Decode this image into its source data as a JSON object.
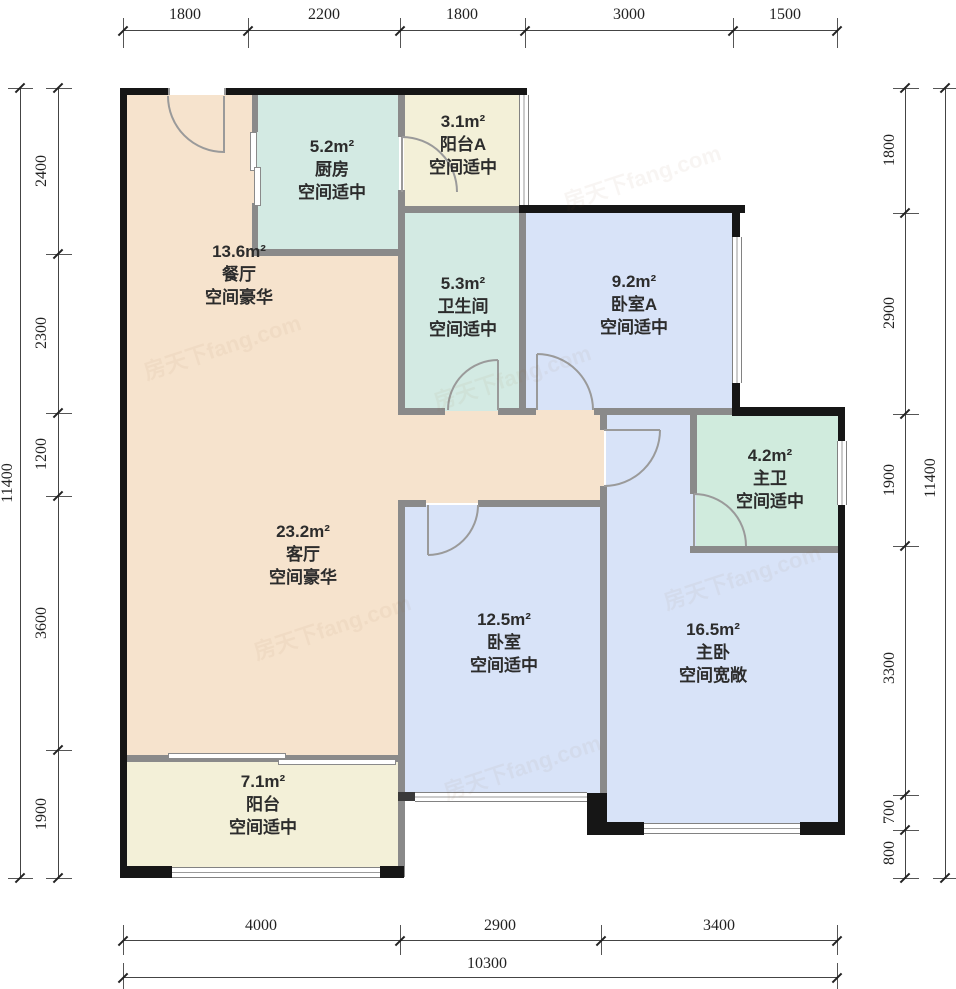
{
  "title": "户型图",
  "colors": {
    "peach": "#f6e3cd",
    "teal": "#d3eae3",
    "blue": "#d8e3f8",
    "cream": "#f3f0d8",
    "mint": "#d0ebdd",
    "wall-black": "#161616",
    "wall-gray": "#8a8a8a"
  },
  "watermark": "房天下fang.com",
  "rooms": [
    {
      "name": "餐厅",
      "area": "13.6m²",
      "spec": "空间豪华"
    },
    {
      "name": "厨房",
      "area": "5.2m²",
      "spec": "空间适中"
    },
    {
      "name": "阳台A",
      "area": "3.1m²",
      "spec": "空间适中"
    },
    {
      "name": "卫生间",
      "area": "5.3m²",
      "spec": "空间适中"
    },
    {
      "name": "卧室A",
      "area": "9.2m²",
      "spec": "空间适中"
    },
    {
      "name": "客厅",
      "area": "23.2m²",
      "spec": "空间豪华"
    },
    {
      "name": "主卫",
      "area": "4.2m²",
      "spec": "空间适中"
    },
    {
      "name": "卧室",
      "area": "12.5m²",
      "spec": "空间适中"
    },
    {
      "name": "主卧",
      "area": "16.5m²",
      "spec": "空间宽敞"
    },
    {
      "name": "阳台",
      "area": "7.1m²",
      "spec": "空间适中"
    }
  ],
  "dimensions": {
    "top": [
      "1800",
      "2200",
      "1800",
      "3000",
      "1500"
    ],
    "bottom": [
      "4000",
      "2900",
      "3400"
    ],
    "bottom_total": "10300",
    "left": [
      "2400",
      "2300",
      "1200",
      "3600",
      "1900"
    ],
    "left_total": "11400",
    "right": [
      "1800",
      "2900",
      "1900",
      "3300",
      "700",
      "800"
    ],
    "right_total": "11400"
  }
}
